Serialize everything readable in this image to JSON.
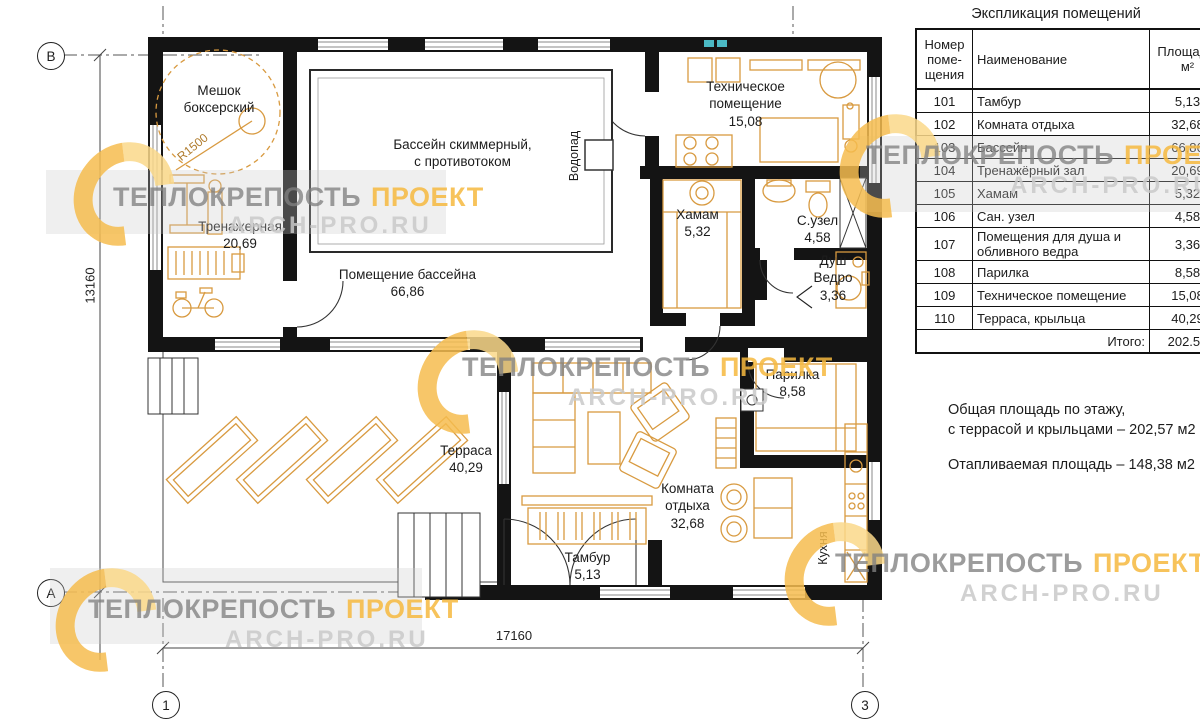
{
  "plan": {
    "boxing_bag": {
      "line1": "Мешок",
      "line2": "боксерский",
      "radius": "R1500"
    },
    "pool": {
      "line1": "Бассейн скиммерный,",
      "line2": "с противотоком"
    },
    "waterfall_label": "Водопад",
    "kitchen_label": "Кухня",
    "rooms": [
      {
        "name": "Тренажерная",
        "area": "20,69"
      },
      {
        "name": "Помещение бассейна",
        "area": "66,86"
      },
      {
        "name": "Техническое помещение",
        "area": "15,08"
      },
      {
        "name": "Хамам",
        "area": "5,32"
      },
      {
        "name": "С.узел",
        "area": "4,58"
      },
      {
        "name": "Душ Ведро",
        "area": "3,36"
      },
      {
        "name": "Парилка",
        "area": "8,58"
      },
      {
        "name": "Комната отдыха",
        "area": "32,68"
      },
      {
        "name": "Тамбур",
        "area": "5,13"
      },
      {
        "name": "Терраса",
        "area": "40,29"
      }
    ],
    "dimensions": {
      "horizontal": "17160",
      "vertical": "13160"
    },
    "axes": {
      "top_left": "В",
      "bottom_left": "А",
      "col_left": "1",
      "col_right": "3"
    }
  },
  "table": {
    "title": "Экспликация помещений",
    "headers": {
      "number": "Номер\nпоме-\nщения",
      "name": "Наименование",
      "area": "Площадь,\nм²"
    },
    "rows": [
      {
        "num": "101",
        "name": "Тамбур",
        "area": "5,13"
      },
      {
        "num": "102",
        "name": "Комната отдыха",
        "area": "32,68"
      },
      {
        "num": "103",
        "name": "Бассейн",
        "area": "66,86"
      },
      {
        "num": "104",
        "name": "Тренажёрный зал",
        "area": "20,69"
      },
      {
        "num": "105",
        "name": "Хамам",
        "area": "5,32"
      },
      {
        "num": "106",
        "name": "Сан. узел",
        "area": "4,58"
      },
      {
        "num": "107",
        "name": "Помещения для душа и обливного ведра",
        "area": "3,36"
      },
      {
        "num": "108",
        "name": "Парилка",
        "area": "8,58"
      },
      {
        "num": "109",
        "name": "Техническое помещение",
        "area": "15,08"
      },
      {
        "num": "110",
        "name": "Терраса, крыльца",
        "area": "40,29"
      }
    ],
    "total_label": "Итого:",
    "total_value": "202.57"
  },
  "notes": {
    "line1": "Общая площадь по этажу,",
    "line2": "с террасой и крыльцами – 202,57 м2",
    "line3": "Отапливаемая площадь – 148,38 м2"
  },
  "watermark": {
    "brand": "ТЕПЛОКРЕПОСТЬ",
    "accent": "ПРОЕКТ",
    "url": "ARCH-PRO.RU"
  },
  "colors": {
    "wall": "#141414",
    "furniture": "#d89a40",
    "accent_gold": "#f6bd4f",
    "cyan_mark": "#4bb9c4"
  }
}
